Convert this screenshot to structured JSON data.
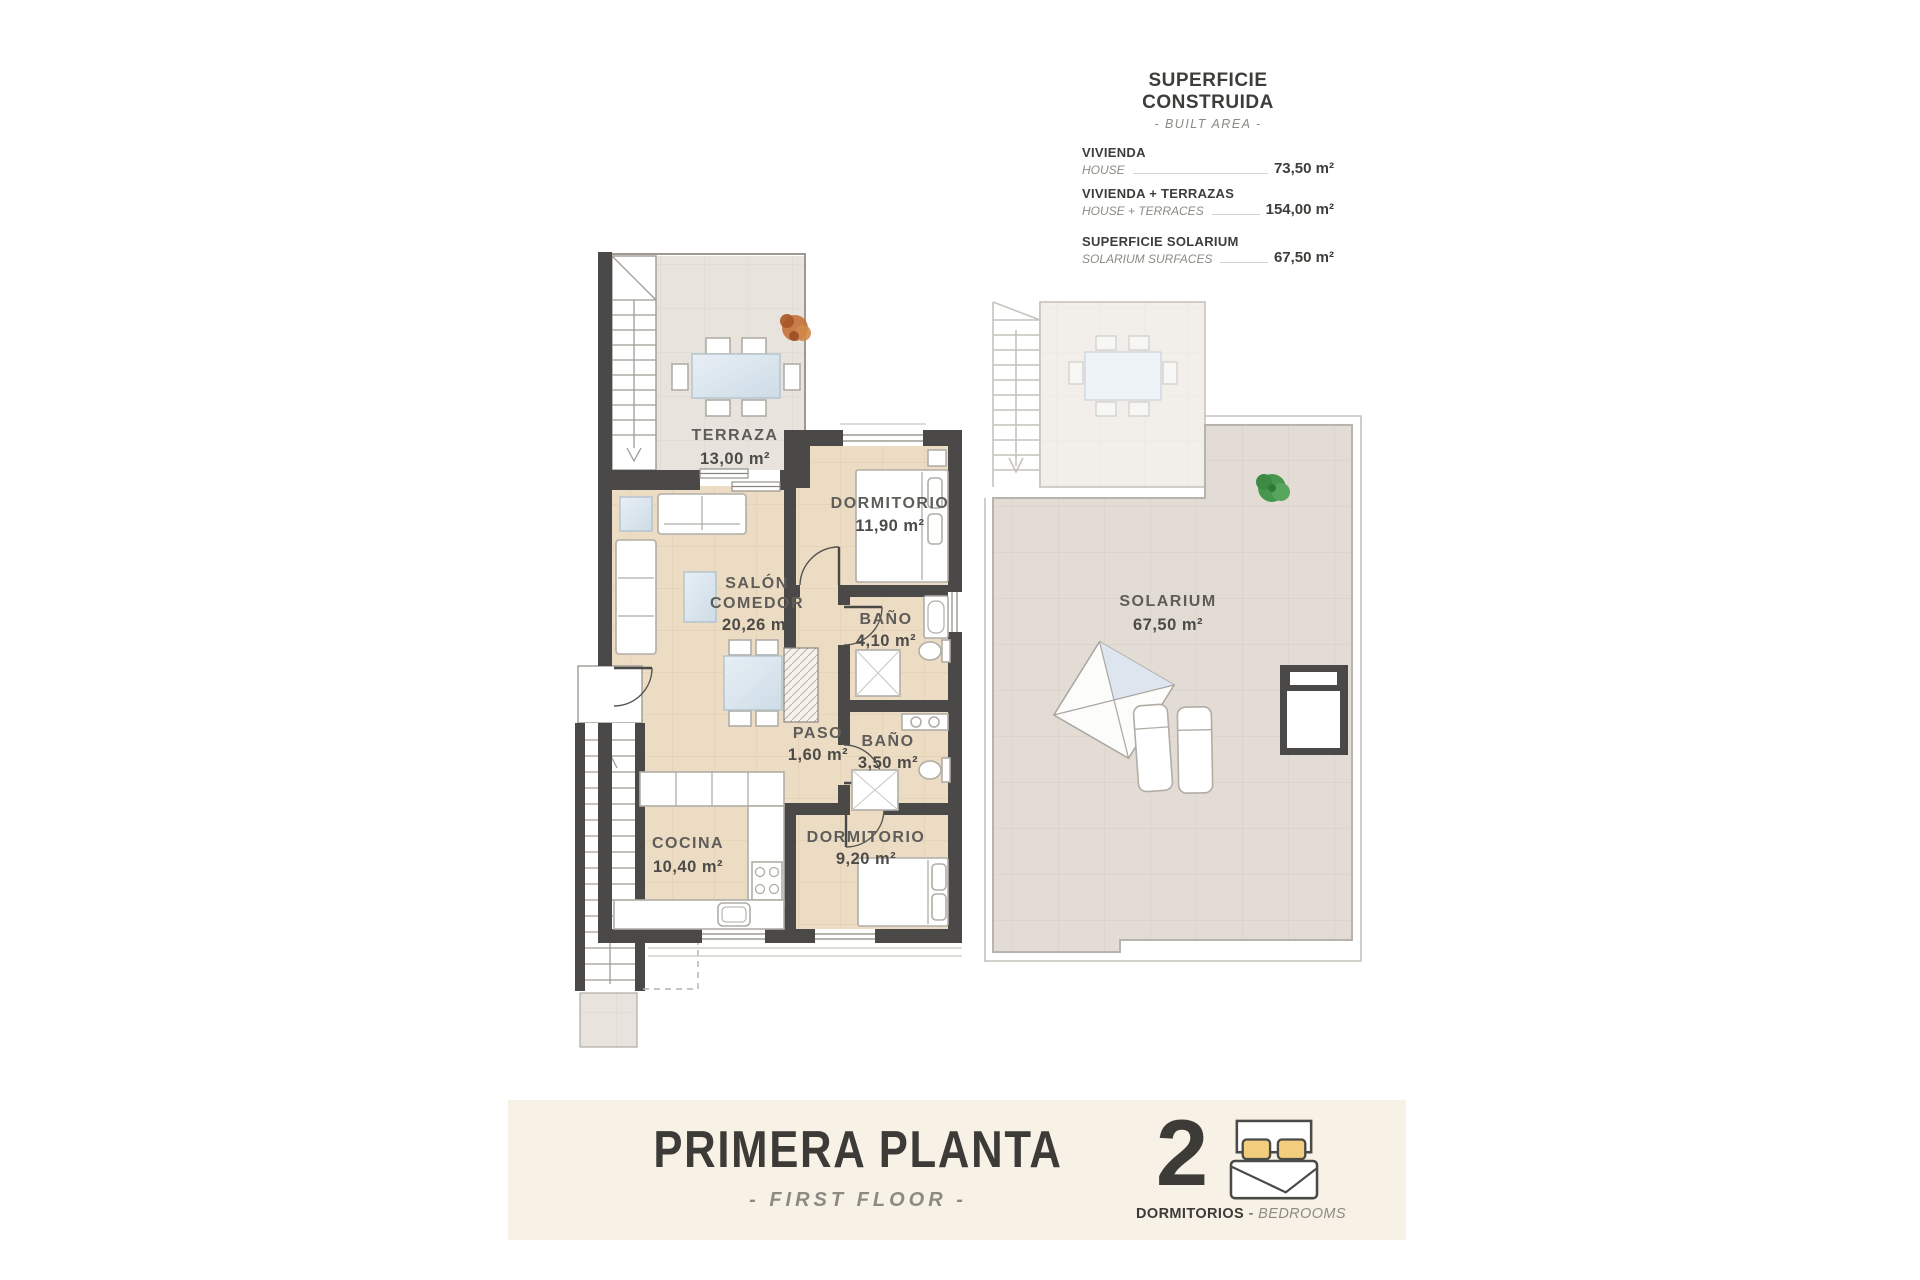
{
  "area_table": {
    "title": "SUPERFICIE CONSTRUIDA",
    "subtitle": "- BUILT AREA -",
    "rows": [
      {
        "label_es": "VIVIENDA",
        "label_en": "HOUSE",
        "value": "73,50 m²"
      },
      {
        "label_es": "VIVIENDA + TERRAZAS",
        "label_en": "HOUSE + TERRACES",
        "value": "154,00 m²"
      },
      {
        "label_es": "SUPERFICIE SOLARIUM",
        "label_en": "SOLARIUM SURFACES",
        "value": "67,50 m²"
      }
    ]
  },
  "rooms": {
    "terraza": {
      "name": "TERRAZA",
      "area": "13,00 m²"
    },
    "dormitorio1": {
      "name": "DORMITORIO",
      "area": "11,90 m²"
    },
    "salon": {
      "name1": "SALÓN",
      "name2": "COMEDOR",
      "area": "20,26 m²"
    },
    "bano1": {
      "name": "BAÑO",
      "area": "4,10 m²"
    },
    "paso": {
      "name": "PASO",
      "area": "1,60 m²"
    },
    "bano2": {
      "name": "BAÑO",
      "area": "3,50 m²"
    },
    "cocina": {
      "name": "COCINA",
      "area": "10,40 m²"
    },
    "dormitorio2": {
      "name": "DORMITORIO",
      "area": "9,20 m²"
    },
    "solarium": {
      "name": "SOLARIUM",
      "area": "67,50 m²"
    }
  },
  "footer": {
    "title": "PRIMERA PLANTA",
    "subtitle": "- FIRST FLOOR -",
    "bedrooms_count": "2",
    "bedrooms_label_es": "DORMITORIOS",
    "bedrooms_sep": " - ",
    "bedrooms_label_en": "BEDROOMS"
  },
  "colors": {
    "wall": "#4a4947",
    "floor_house": "#ecdcc3",
    "floor_terrace": "#e8e3dd",
    "floor_solarium": "#e3dcd4",
    "footer_background": "#f8f1e6",
    "pillow_yellow": "#f1cd7d",
    "text_dark": "#3e3d3a",
    "text_gray_italic": "#8d8a84"
  }
}
